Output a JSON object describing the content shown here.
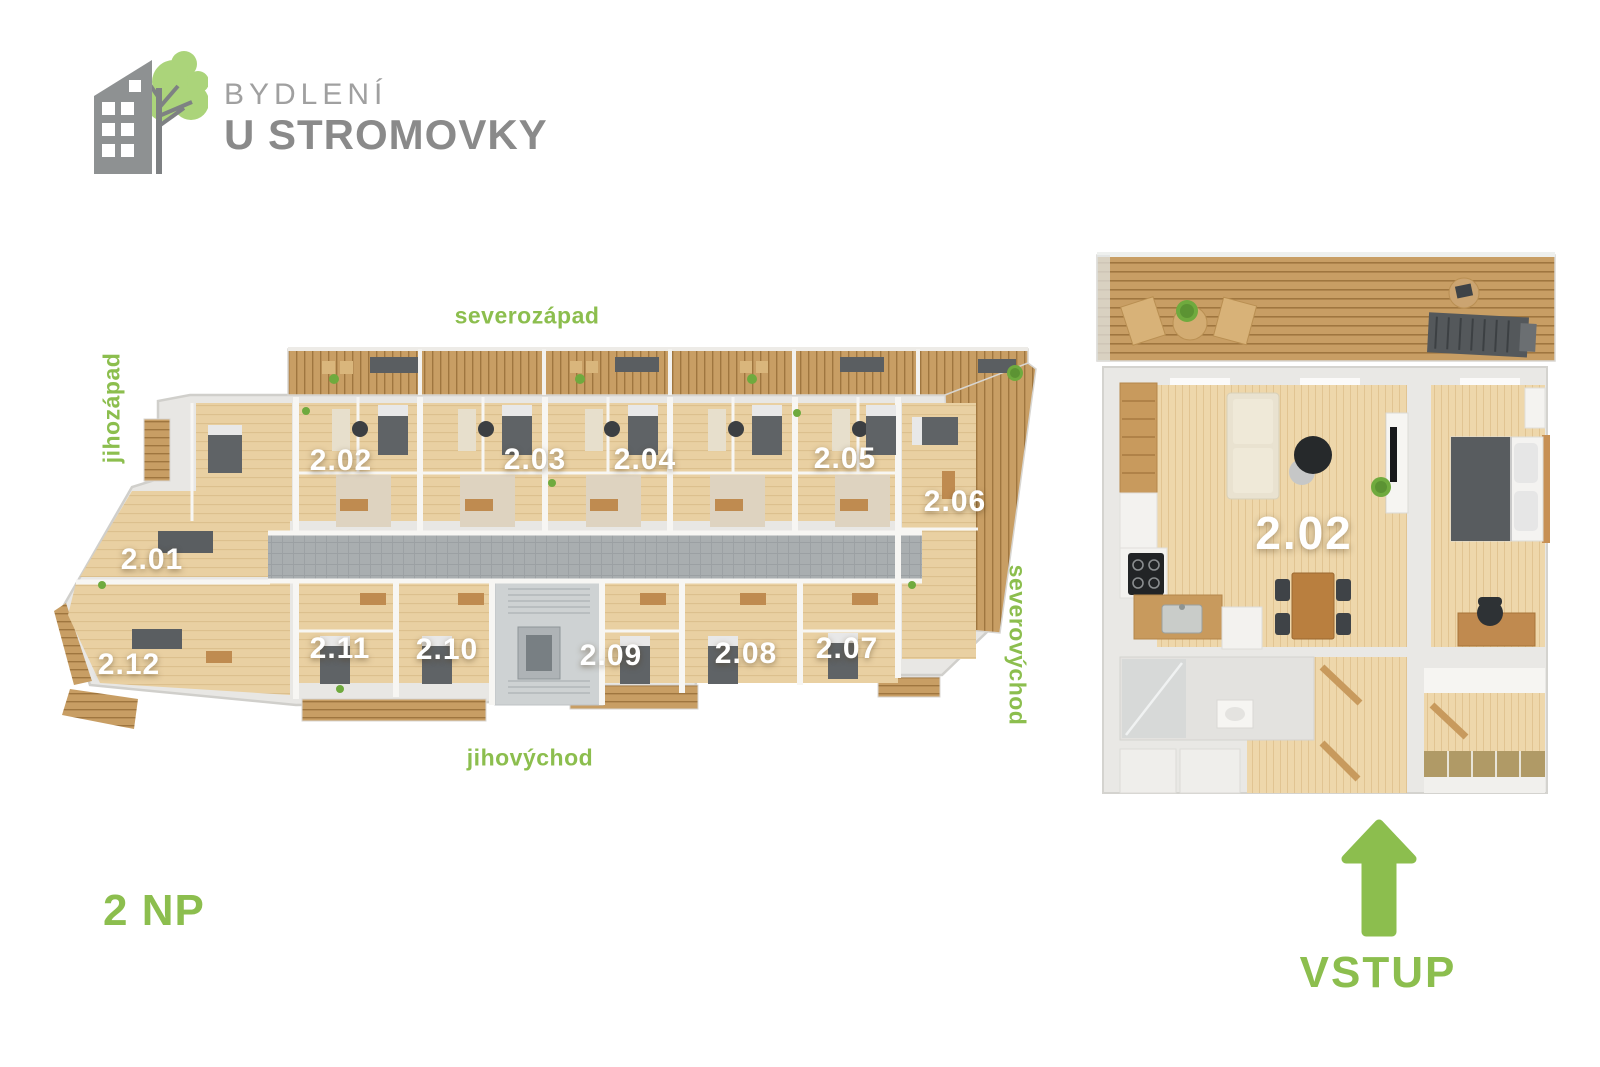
{
  "logo": {
    "line1": "BYDLENÍ",
    "line2": "U STROMOVKY"
  },
  "floor_label": "2 NP",
  "directions": {
    "north_west": "severozápad",
    "south_west": "jihozápad",
    "north_east": "severovýchod",
    "south_east": "jihovýchod"
  },
  "main_plan": {
    "units": [
      {
        "label": "2.01",
        "x": 152,
        "y": 560
      },
      {
        "label": "2.02",
        "x": 341,
        "y": 461
      },
      {
        "label": "2.03",
        "x": 535,
        "y": 460
      },
      {
        "label": "2.04",
        "x": 645,
        "y": 460
      },
      {
        "label": "2.05",
        "x": 845,
        "y": 459
      },
      {
        "label": "2.06",
        "x": 955,
        "y": 502
      },
      {
        "label": "2.07",
        "x": 847,
        "y": 649
      },
      {
        "label": "2.08",
        "x": 746,
        "y": 654
      },
      {
        "label": "2.09",
        "x": 611,
        "y": 656
      },
      {
        "label": "2.10",
        "x": 447,
        "y": 650
      },
      {
        "label": "2.11",
        "x": 340,
        "y": 649
      },
      {
        "label": "2.12",
        "x": 129,
        "y": 665
      }
    ]
  },
  "detail_plan": {
    "unit_label": "2.02",
    "entrance_label": "VSTUP"
  },
  "colors": {
    "accent_green": "#8cbe4e",
    "tree_green": "#abd47a",
    "wood_floor": "#e9d0a2",
    "deck_wood": "#c89e64",
    "wall": "#e8e7e4",
    "corridor_gray": "#a9aeb0",
    "logo_gray": "#8a8a8a",
    "label_white": "#ffffff"
  }
}
